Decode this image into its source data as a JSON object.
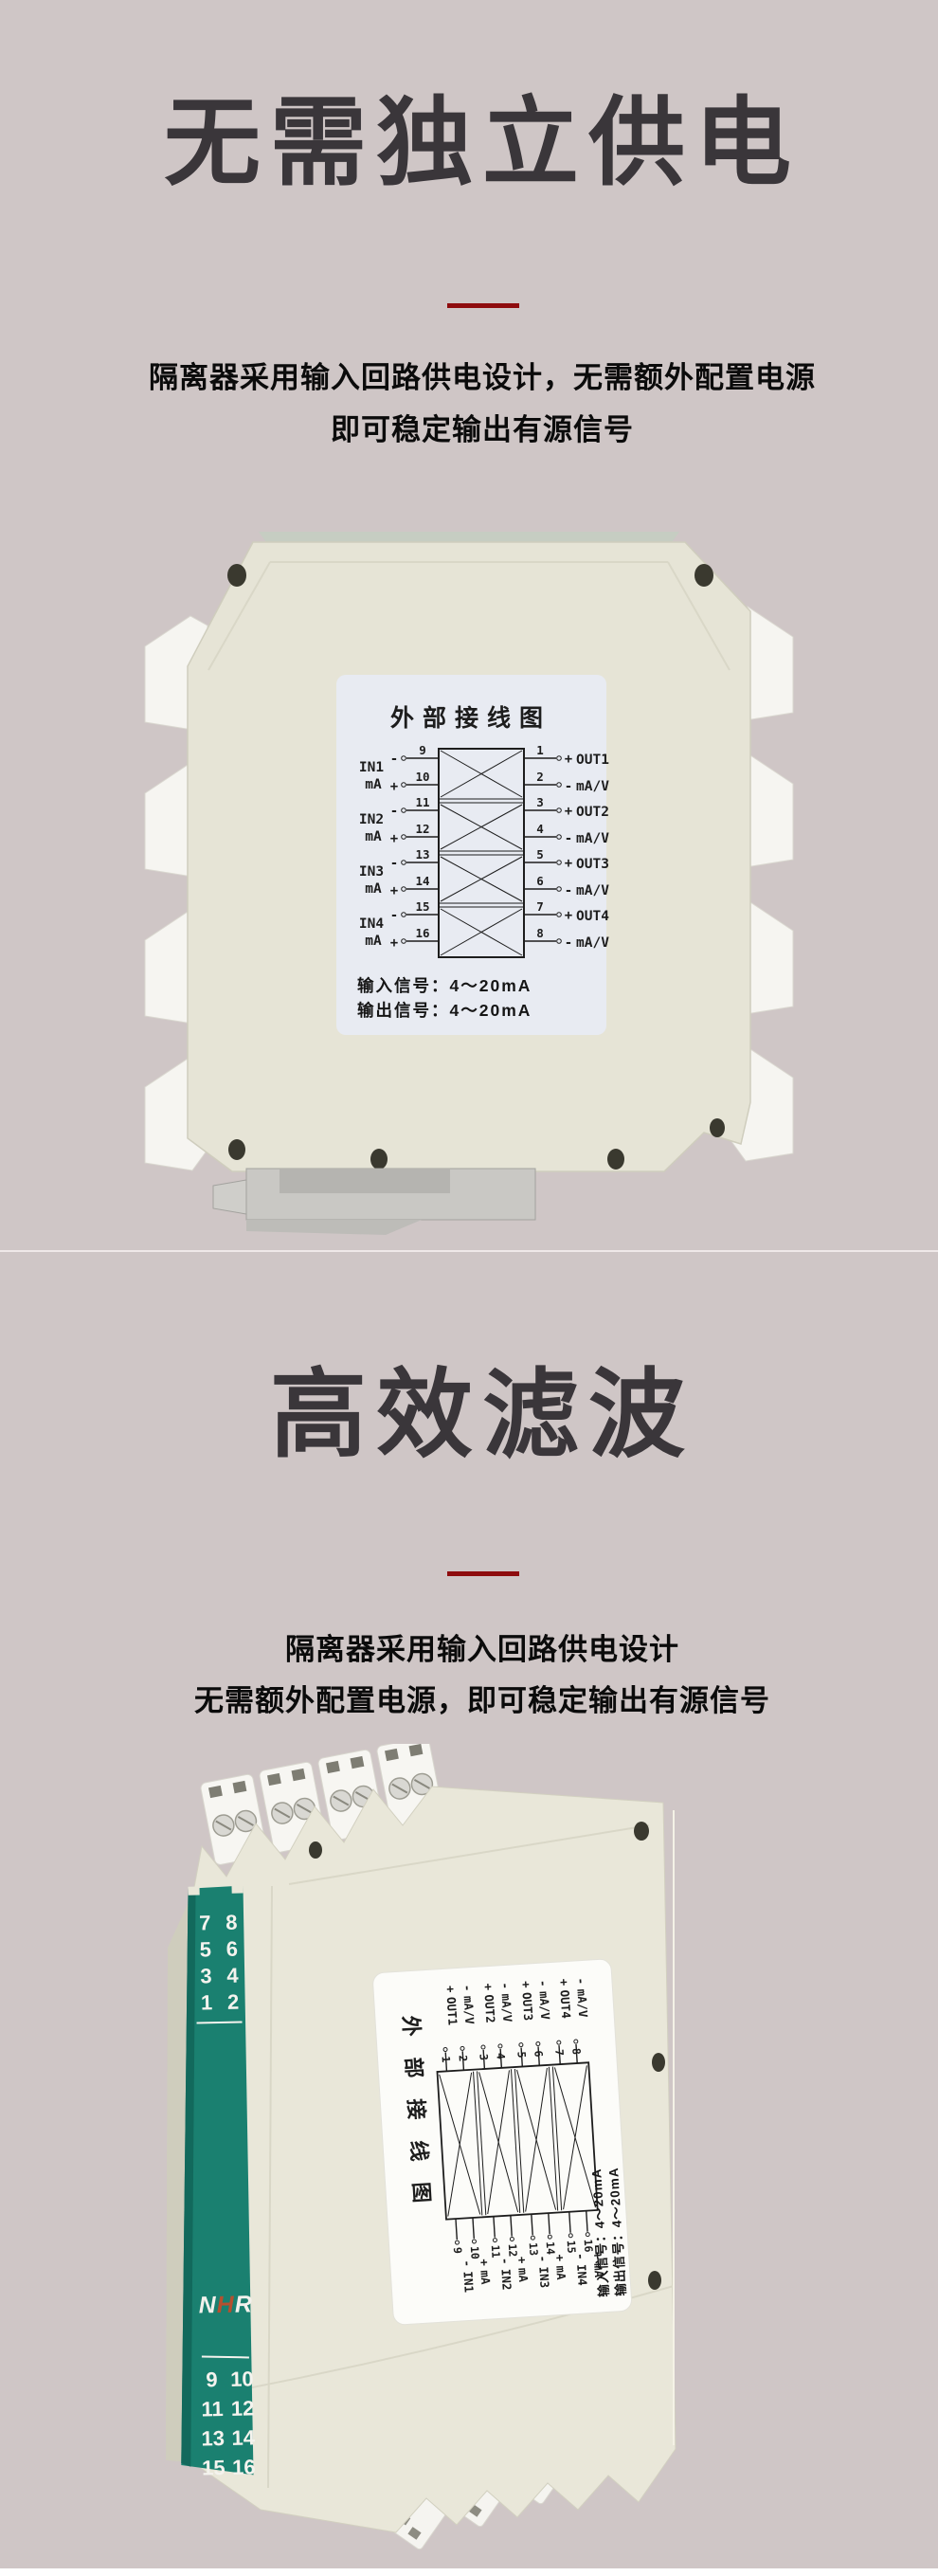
{
  "page": {
    "background": "#cfc6c6",
    "seam_color": "#efe8e8",
    "footer_bar_color": "#ffffff",
    "heading_color": "#3a363a",
    "divider_color": "#8e0c0e"
  },
  "section_power": {
    "heading": "无需独立供电",
    "desc_line1": "隔离器采用输入回路供电设计，无需额外配置电源",
    "desc_line2": "即可稳定输出有源信号"
  },
  "section_filter": {
    "heading": "高效滤波",
    "desc_line1": "隔离器采用输入回路供电设计",
    "desc_line2": "无需额外配置电源，即可稳定输出有源信号"
  },
  "wiring": {
    "title": "外部接线图",
    "title_chars": [
      "外",
      "部",
      "接",
      "线",
      "图"
    ],
    "inputs": [
      {
        "name": "IN1",
        "unit": "mA",
        "neg": "-",
        "pos": "+",
        "neg_no": "9",
        "pos_no": "10"
      },
      {
        "name": "IN2",
        "unit": "mA",
        "neg": "-",
        "pos": "+",
        "neg_no": "11",
        "pos_no": "12"
      },
      {
        "name": "IN3",
        "unit": "mA",
        "neg": "-",
        "pos": "+",
        "neg_no": "13",
        "pos_no": "14"
      },
      {
        "name": "IN4",
        "unit": "mA",
        "neg": "-",
        "pos": "+",
        "neg_no": "15",
        "pos_no": "16"
      }
    ],
    "outputs": [
      {
        "name": "OUT1",
        "unit": "mA/V",
        "pos": "+",
        "neg": "-",
        "pos_no": "1",
        "neg_no": "2"
      },
      {
        "name": "OUT2",
        "unit": "mA/V",
        "pos": "+",
        "neg": "-",
        "pos_no": "3",
        "neg_no": "4"
      },
      {
        "name": "OUT3",
        "unit": "mA/V",
        "pos": "+",
        "neg": "-",
        "pos_no": "5",
        "neg_no": "6"
      },
      {
        "name": "OUT4",
        "unit": "mA/V",
        "pos": "+",
        "neg": "-",
        "pos_no": "7",
        "neg_no": "8"
      }
    ],
    "input_signal": "输入信号：4～20mA",
    "output_signal": "输出信号：4～20mA"
  },
  "device_side": {
    "brand": "NHR",
    "brand_chars": [
      "N",
      "H",
      "R"
    ],
    "brand_h_color": "#b5502f",
    "strip_color": "#1a8070",
    "top_terminals": [
      "7",
      "8",
      "5",
      "6",
      "3",
      "4",
      "1",
      "2"
    ],
    "bottom_terminals": [
      "9",
      "10",
      "11",
      "12",
      "13",
      "14",
      "15",
      "16"
    ]
  }
}
